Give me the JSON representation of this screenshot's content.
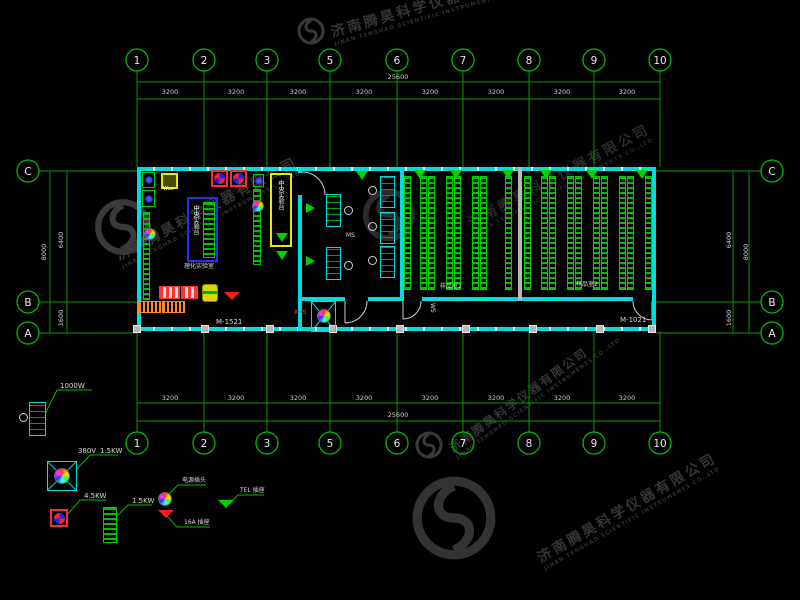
{
  "watermark": {
    "cn": "济南腾昊科学仪器有限公司",
    "en": "JINAN TENGHAO SCIENTIFIC INSTRUMENTS CO.,LTD"
  },
  "axes": {
    "top": [
      "1",
      "2",
      "3",
      "5",
      "6",
      "7",
      "8",
      "9",
      "10"
    ],
    "bottom": [
      "1",
      "2",
      "3",
      "5",
      "6",
      "7",
      "8",
      "9",
      "10"
    ],
    "left": [
      "C",
      "B",
      "A"
    ],
    "right": [
      "C",
      "B",
      "A"
    ]
  },
  "dims": {
    "top_segments": [
      "3200",
      "3200",
      "3200",
      "3200",
      "3200",
      "3200",
      "3200",
      "3200"
    ],
    "top_total": "25600",
    "bottom_segments": [
      "3200",
      "3200",
      "3200",
      "3200",
      "3200",
      "3200",
      "3200",
      "3200"
    ],
    "bottom_total": "25600",
    "left": {
      "span_cb": "6400",
      "span_ba": "1600",
      "overall": "8000"
    },
    "right": {
      "span_cb": "6400",
      "span_ba": "1600",
      "overall": "8000"
    }
  },
  "plan": {
    "door_left": "M-1521",
    "door_right": "M-1021",
    "lab_label": "理化实验室",
    "central_bench": "中央实验台",
    "central_bench2": "中央实验台",
    "room1_label": "样品室1",
    "room2_label": "样品室2",
    "ws": "WS",
    "ms": "MS",
    "xhs": "XHS",
    "wax": "Wax"
  },
  "legend": {
    "w1000": "1000W",
    "v380": "380V",
    "kw15": "1.5KW",
    "kw45": "4.5KW",
    "kw15b": "1.5KW",
    "plug_label": "电源插头",
    "socket_label": "16A 插座",
    "tel_label": "TEL 插座"
  }
}
